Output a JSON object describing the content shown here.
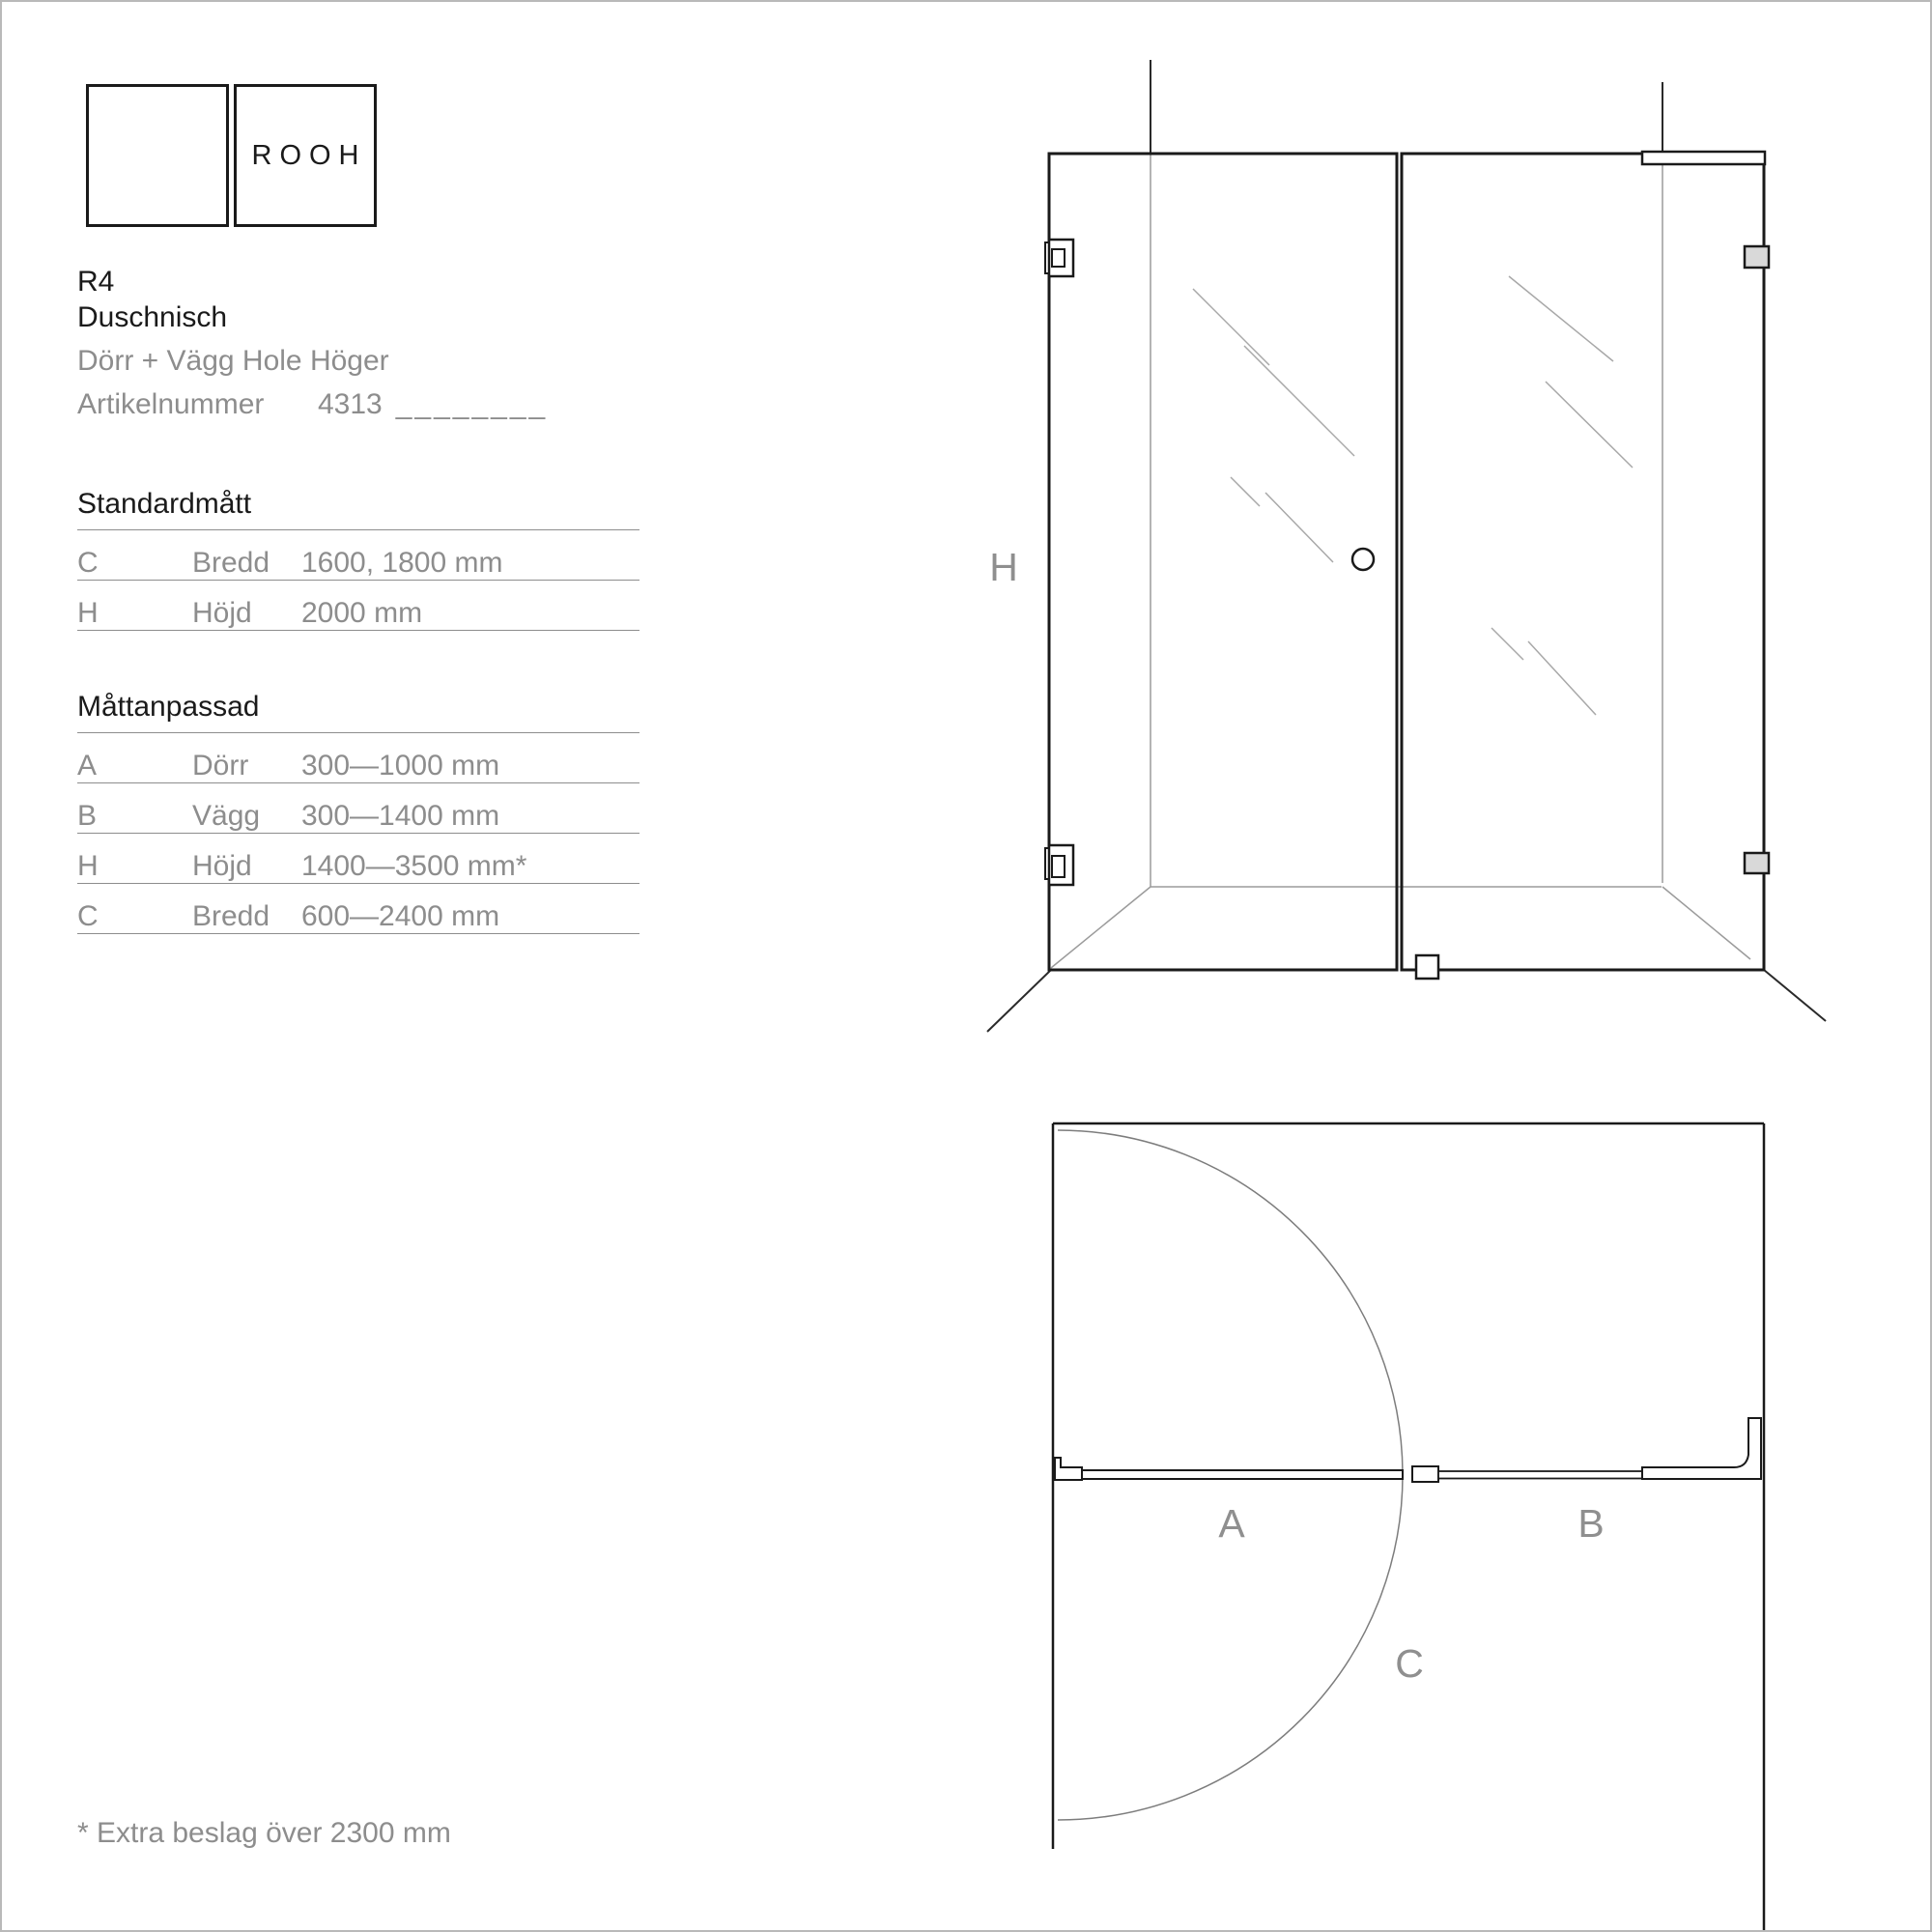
{
  "brand": {
    "logo_text": "ROOH"
  },
  "product": {
    "model": "R4",
    "name": "Duschnisch",
    "variant": "Dörr + Vägg Hole Höger",
    "article_label": "Artikelnummer",
    "article_number": "4313",
    "article_blank": "________"
  },
  "standard_table": {
    "title": "Standardmått",
    "rows": [
      {
        "code": "C",
        "label": "Bredd",
        "value": "1600, 1800 mm"
      },
      {
        "code": "H",
        "label": "Höjd",
        "value": "2000 mm"
      }
    ]
  },
  "custom_table": {
    "title": "Måttanpassad",
    "rows": [
      {
        "code": "A",
        "label": "Dörr",
        "value": "300—1000 mm"
      },
      {
        "code": "B",
        "label": "Vägg",
        "value": "300—1400 mm"
      },
      {
        "code": "H",
        "label": "Höjd",
        "value": "1400—3500 mm*"
      },
      {
        "code": "C",
        "label": "Bredd",
        "value": "600—2400 mm"
      }
    ]
  },
  "footnote": "* Extra beslag över 2300 mm",
  "elevation": {
    "height_label": "H"
  },
  "plan": {
    "door_label": "A",
    "wall_label": "B",
    "width_label": "C"
  },
  "colors": {
    "text_dark": "#1a1a1a",
    "text_gray": "#8d8d8d",
    "construction_line_gray": "#9b9b9b",
    "fitting_fill_gray": "#d9d9d9"
  }
}
